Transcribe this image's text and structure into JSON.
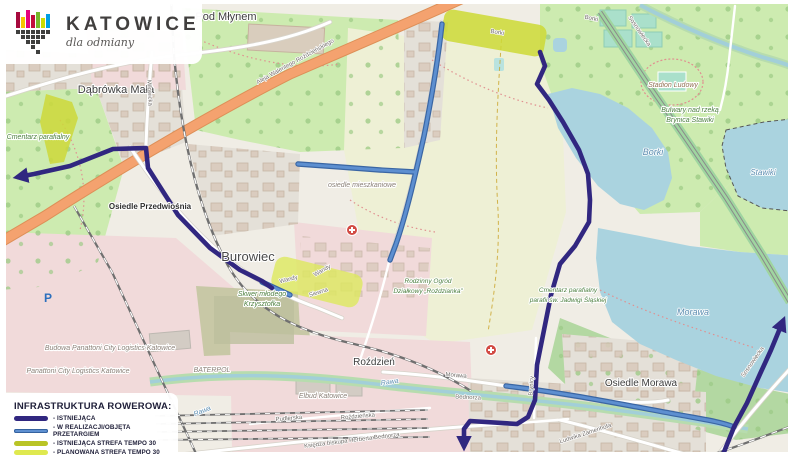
{
  "logo": {
    "title": "KATOWICE",
    "tagline": "dla odmiany"
  },
  "legend": {
    "title": "INFRASTRUKTURA ROWEROWA:",
    "items": [
      {
        "label": "- ISTNIEJĄCA",
        "color": "#312780"
      },
      {
        "label": "- W REALIZACJI/OBJĘTA PRZETARGIEM",
        "color": "#5d8fd0"
      },
      {
        "label": "- ISTNIEJĄCA STREFA TEMPO 30",
        "color": "#b9c426"
      },
      {
        "label": "- PLANOWANA STREFA TEMPO 30",
        "color": "#dfe94f"
      }
    ]
  },
  "map": {
    "route_colors": {
      "existing": "#312780",
      "in_progress": "#5d8fd0",
      "tempo30_existing": "#b9c426",
      "tempo30_planned": "#dfe94f"
    },
    "places": [
      {
        "text": "Pod Młynem"
      },
      {
        "text": "Dąbrówka Mała"
      },
      {
        "text": "Osiedle Przedwiośnia"
      },
      {
        "text": "Burowiec"
      },
      {
        "text": "Roździeń"
      },
      {
        "text": "Osiedle Morawa"
      },
      {
        "text": "BATERPOL"
      },
      {
        "text": "Elbud Katowice"
      },
      {
        "text": "Panattoni City Logistics Katowice"
      },
      {
        "text": "Budowa Panattoni City Logistics Katowice"
      },
      {
        "text": "Stadion Ludowy"
      },
      {
        "text": "Bulwary nad rzeką"
      },
      {
        "text": "Brynica Stawiki"
      },
      {
        "text": "Cmentarz parafialny"
      },
      {
        "text": "Cmentarz parafialny"
      },
      {
        "text": "parafii św. Jadwigi Śląskiej"
      },
      {
        "text": "Rodzinny Ogród"
      },
      {
        "text": "Działkowy „Roździanka”"
      },
      {
        "text": "Skwer młodego"
      },
      {
        "text": "Krzysztofka"
      },
      {
        "text": "osiedle mieszkaniowe"
      }
    ],
    "water_labels": [
      {
        "text": "Borki"
      },
      {
        "text": "Stawiki"
      },
      {
        "text": "Morawa"
      },
      {
        "text": "Rawa"
      },
      {
        "text": "Rawa"
      }
    ],
    "street_labels": [
      {
        "text": "Aleja Walentego Roździeńskiego"
      },
      {
        "text": "Borki"
      },
      {
        "text": "Borki"
      },
      {
        "text": "Wandy"
      },
      {
        "text": "Wandy"
      },
      {
        "text": "Siewna"
      },
      {
        "text": "Morawa"
      },
      {
        "text": "Bednorza"
      },
      {
        "text": "Księdza biskupa Herberta Bednorza"
      },
      {
        "text": "Ludwika Zamenhofa"
      },
      {
        "text": "Roździeńska"
      },
      {
        "text": "Pudlerska"
      },
      {
        "text": "Sosnowiecka"
      },
      {
        "text": "Sosnowiecka"
      },
      {
        "text": "Milowicka"
      },
      {
        "text": "Brynicy"
      }
    ],
    "icons": {
      "parking_letter": "P",
      "hospital": "medical-cross-icon"
    }
  }
}
